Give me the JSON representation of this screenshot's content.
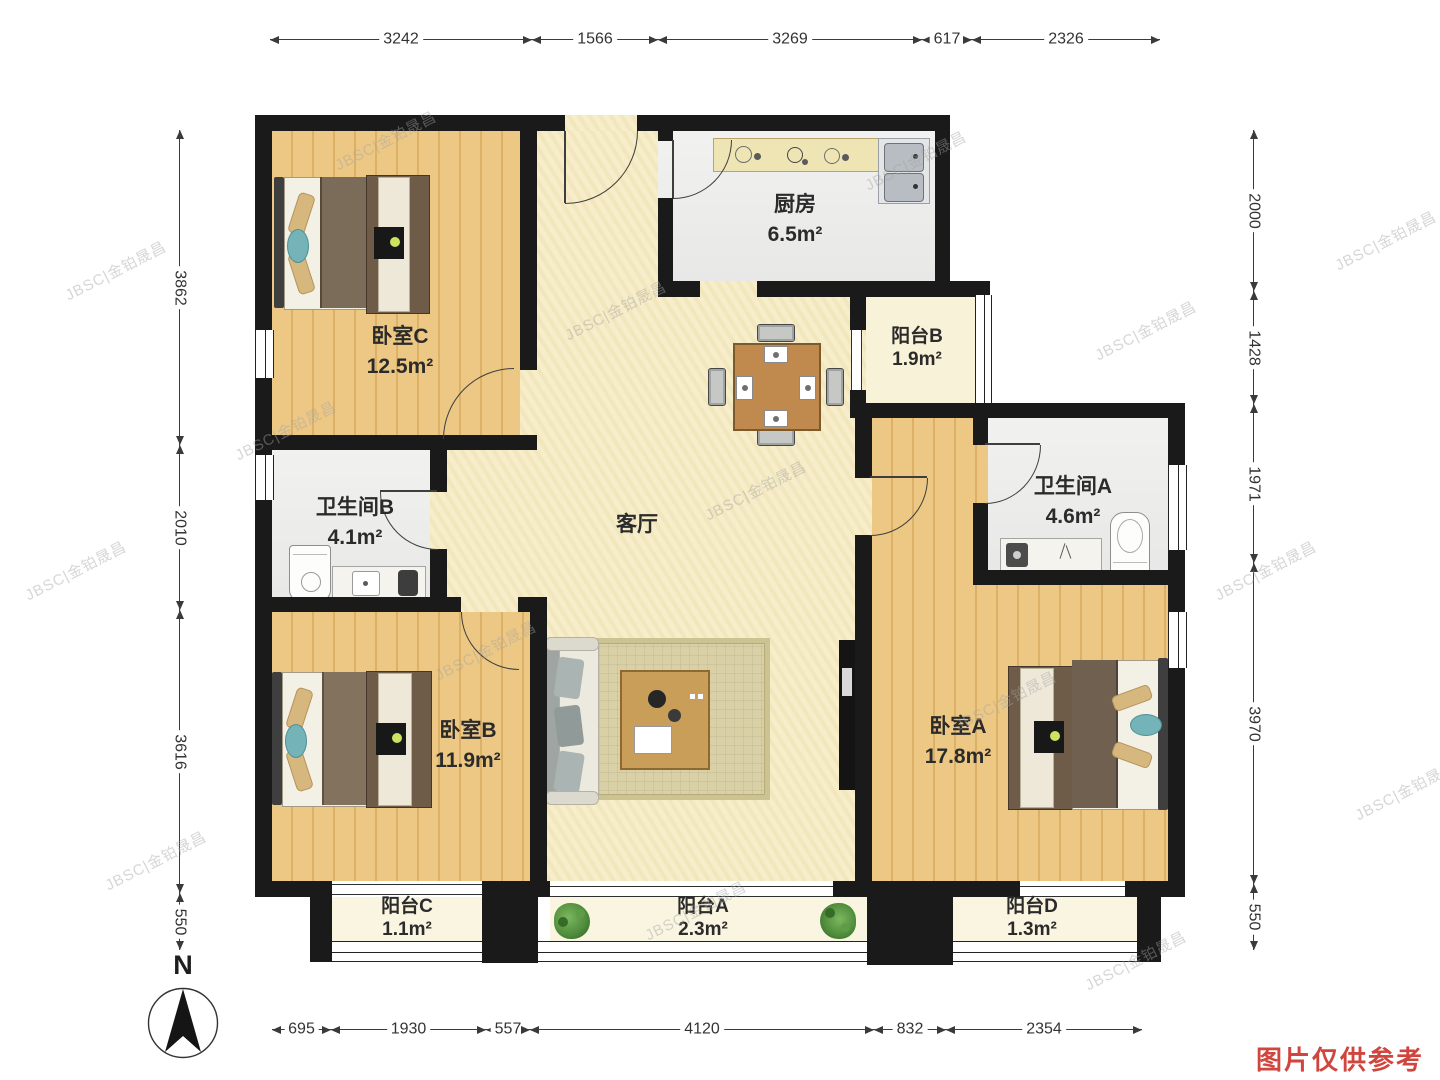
{
  "meta": {
    "compass_label": "N",
    "disclaimer": "图片仅供参考",
    "watermark": "JBSC|金铂晟昌"
  },
  "rooms": {
    "bedroom_c": {
      "name": "卧室C",
      "area": "12.5m²"
    },
    "kitchen": {
      "name": "厨房",
      "area": "6.5m²"
    },
    "balcony_b": {
      "name": "阳台B",
      "area": "1.9m²"
    },
    "bathroom_b": {
      "name": "卫生间B",
      "area": "4.1m²"
    },
    "bathroom_a": {
      "name": "卫生间A",
      "area": "4.6m²"
    },
    "living_room": {
      "name": "客厅",
      "area": ""
    },
    "bedroom_b": {
      "name": "卧室B",
      "area": "11.9m²"
    },
    "bedroom_a": {
      "name": "卧室A",
      "area": "17.8m²"
    },
    "balcony_c": {
      "name": "阳台C",
      "area": "1.1m²"
    },
    "balcony_a": {
      "name": "阳台A",
      "area": "2.3m²"
    },
    "balcony_d": {
      "name": "阳台D",
      "area": "1.3m²"
    }
  },
  "dimensions_mm": {
    "top": [
      "3242",
      "1566",
      "3269",
      "617",
      "2326"
    ],
    "bottom": [
      "695",
      "1930",
      "557",
      "4120",
      "832",
      "2354"
    ],
    "left": [
      "3862",
      "2010",
      "3616",
      "550"
    ],
    "right": [
      "2000",
      "1428",
      "1971",
      "3970",
      "550"
    ]
  },
  "colors": {
    "wall": "#1a1a1a",
    "wood_floor": "#e9c27c",
    "tile_floor": "#ededed",
    "living_floor": "#f6ecc6",
    "balcony_floor": "#faf5e0",
    "disclaimer_red": "#d0453e"
  }
}
